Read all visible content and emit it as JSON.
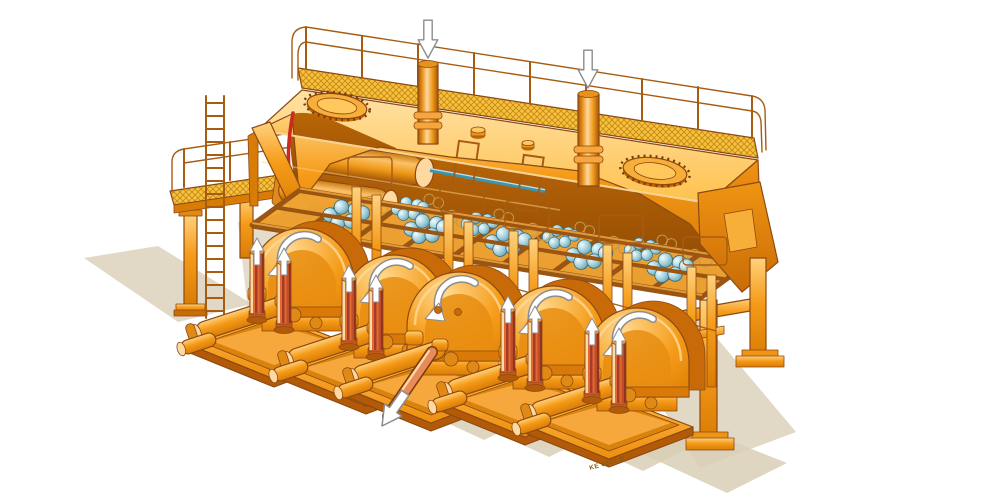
{
  "branding": {
    "wordmark": "Putzmeister"
  },
  "markings": {
    "skid_stencil": "KE 0935 B"
  },
  "counts": {
    "pump_units": 5,
    "pulsation_dampeners": 8,
    "inlet_pipes": 2,
    "manhole_covers": 2,
    "inlet_down_arrows": 2,
    "dampener_up_arrows": 8,
    "arch_flow_arrows": 5,
    "discharge_arrows": 1
  },
  "colors": {
    "body": "#F59B18",
    "body_light": "#FFC75C",
    "body_highlight": "#FFE2A6",
    "body_deep": "#D97C06",
    "outline": "#8C4A12",
    "interior_dark": "#9C5A06",
    "mesh": "#F5C33A",
    "mesh_line": "#C8871C",
    "rail": "#A85C12",
    "valve_teal": "#7FB9C9",
    "valve_teal_light": "#E4F4F8",
    "valve_teal_dark": "#39707F",
    "dampener": "#E06A33",
    "dampener_stripe": "#A93B26",
    "cut_red": "#CC2A1E",
    "rod_blue": "#3E93AD",
    "shadow": "#D9CFB6",
    "arrow_fill": "#FFFFFF",
    "arrow_outline": "#8C8C8C",
    "logo_dark": "#252B36",
    "stencil": "#8A5C10",
    "background": "#FFFFFF"
  }
}
